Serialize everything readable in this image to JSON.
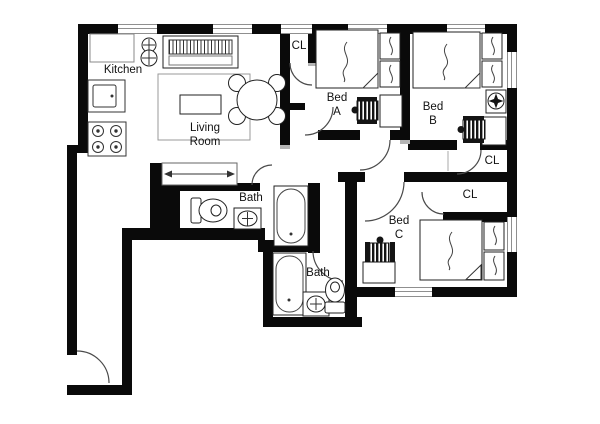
{
  "canvas": {
    "width": 600,
    "height": 424,
    "background": "#ffffff"
  },
  "colors": {
    "wall": "#0a0a0a",
    "window_line": "#8f8f8f",
    "door_arc": "#4a4a4a",
    "furniture_line": "#222222",
    "label_text": "#111111"
  },
  "labels": {
    "kitchen": "Kitchen",
    "living_room": {
      "line1": "Living",
      "line2": "Room"
    },
    "bed_a": {
      "line1": "Bed",
      "line2": "A"
    },
    "bed_b": {
      "line1": "Bed",
      "line2": "B"
    },
    "bed_c": {
      "line1": "Bed",
      "line2": "C"
    },
    "bath_upper": "Bath",
    "bath_lower": "Bath",
    "closet_hall": "CL",
    "closet_bed_b": "CL",
    "closet_bed_c": "CL"
  },
  "furniture": {
    "kitchen": [
      "counter",
      "kitchen-sink",
      "stove"
    ],
    "living_room": [
      "sofa",
      "floor-plant",
      "rug",
      "coffee-table",
      "dining-table",
      "dining-chairs"
    ],
    "hall": [
      "sliding-door-closet"
    ],
    "bed_a": [
      "double-bed",
      "nightstand",
      "nightstand",
      "desk",
      "desk-chair"
    ],
    "bed_b": [
      "double-bed",
      "nightstand",
      "nightstand",
      "ceiling-fan-symbol",
      "desk",
      "desk-chair"
    ],
    "bed_c": [
      "double-bed",
      "nightstand",
      "nightstand",
      "desk",
      "desk-chair"
    ],
    "bath_upper": [
      "toilet",
      "sink",
      "bathtub"
    ],
    "bath_lower": [
      "bathtub",
      "sink",
      "toilet"
    ]
  }
}
